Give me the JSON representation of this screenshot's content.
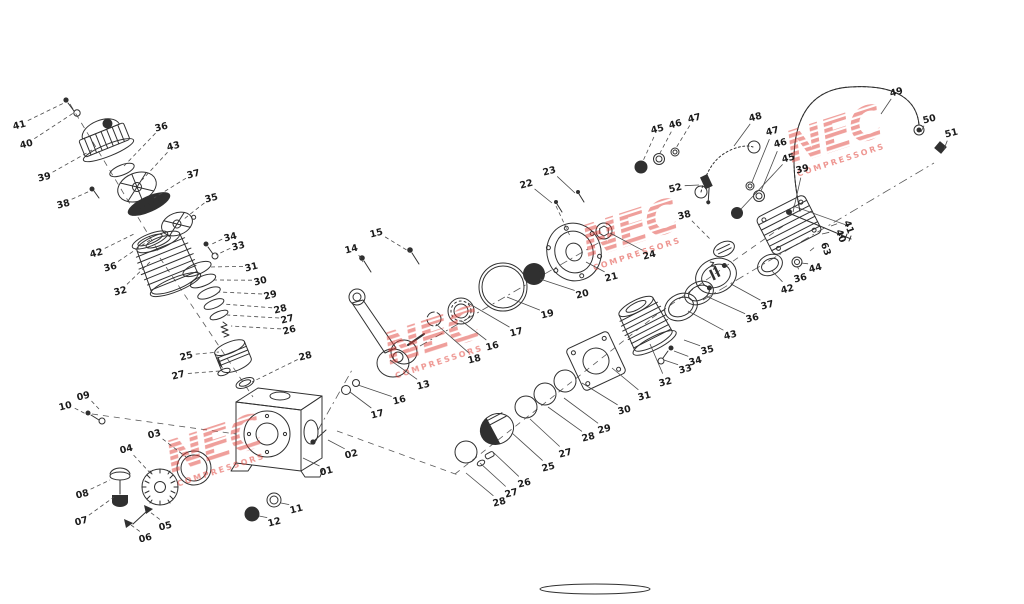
{
  "diagram": {
    "type": "exploded-parts-diagram",
    "subject": "air compressor pump exploded parts view",
    "background": "#ffffff",
    "line_color": "#303030",
    "watermark": {
      "primary": "NEC",
      "secondary": "COMPRESSORS",
      "color": "#e04038",
      "stamps": [
        {
          "x": 218,
          "y": 460,
          "r": -18
        },
        {
          "x": 436,
          "y": 352,
          "r": -18
        },
        {
          "x": 634,
          "y": 244,
          "r": -18
        },
        {
          "x": 838,
          "y": 150,
          "r": -18
        }
      ]
    },
    "labels": [
      {
        "n": "41",
        "x": 20,
        "y": 128,
        "tx": 64,
        "ty": 103,
        "ls": "d"
      },
      {
        "n": "40",
        "x": 27,
        "y": 147,
        "tx": 75,
        "ty": 112,
        "ls": "d"
      },
      {
        "n": "39",
        "x": 45,
        "y": 180,
        "tx": 92,
        "ty": 150,
        "ls": "d"
      },
      {
        "n": "36",
        "x": 162,
        "y": 130,
        "tx": 124,
        "ty": 166,
        "ls": "d"
      },
      {
        "n": "43",
        "x": 174,
        "y": 149,
        "tx": 142,
        "ty": 180,
        "ls": "d"
      },
      {
        "n": "37",
        "x": 194,
        "y": 177,
        "tx": 154,
        "ty": 198,
        "ls": "d"
      },
      {
        "n": "38",
        "x": 64,
        "y": 207,
        "tx": 90,
        "ty": 191,
        "ls": "d"
      },
      {
        "n": "35",
        "x": 212,
        "y": 201,
        "tx": 184,
        "ty": 219,
        "ls": "d"
      },
      {
        "n": "42",
        "x": 97,
        "y": 256,
        "tx": 136,
        "ty": 233,
        "ls": "d"
      },
      {
        "n": "36",
        "x": 111,
        "y": 270,
        "tx": 150,
        "ty": 240,
        "ls": "d"
      },
      {
        "n": "32",
        "x": 121,
        "y": 294,
        "tx": 150,
        "ty": 262,
        "ls": "d"
      },
      {
        "n": "34",
        "x": 231,
        "y": 240,
        "tx": 210,
        "ty": 245,
        "ls": "d"
      },
      {
        "n": "33",
        "x": 239,
        "y": 249,
        "tx": 216,
        "ty": 255,
        "ls": "d"
      },
      {
        "n": "31",
        "x": 252,
        "y": 270,
        "tx": 210,
        "ty": 267,
        "ls": "d"
      },
      {
        "n": "30",
        "x": 261,
        "y": 284,
        "tx": 214,
        "ty": 280,
        "ls": "d"
      },
      {
        "n": "29",
        "x": 271,
        "y": 298,
        "tx": 219,
        "ty": 292,
        "ls": "d"
      },
      {
        "n": "28",
        "x": 281,
        "y": 312,
        "tx": 223,
        "ty": 304,
        "ls": "d"
      },
      {
        "n": "27",
        "x": 288,
        "y": 322,
        "tx": 227,
        "ty": 315,
        "ls": "d"
      },
      {
        "n": "26",
        "x": 290,
        "y": 333,
        "tx": 231,
        "ty": 326,
        "ls": "d"
      },
      {
        "n": "25",
        "x": 187,
        "y": 359,
        "tx": 219,
        "ty": 352,
        "ls": "d"
      },
      {
        "n": "27",
        "x": 179,
        "y": 378,
        "tx": 220,
        "ty": 371,
        "ls": "d"
      },
      {
        "n": "28",
        "x": 306,
        "y": 359,
        "tx": 252,
        "ty": 382,
        "ls": "d"
      },
      {
        "n": "10",
        "x": 66,
        "y": 409,
        "tx": 86,
        "ty": 414,
        "ls": "d"
      },
      {
        "n": "09",
        "x": 84,
        "y": 399,
        "tx": 99,
        "ty": 409,
        "ls": "d"
      },
      {
        "n": "03",
        "x": 155,
        "y": 437,
        "tx": 186,
        "ty": 457,
        "ls": "d"
      },
      {
        "n": "04",
        "x": 127,
        "y": 452,
        "tx": 152,
        "ty": 475,
        "ls": "d"
      },
      {
        "n": "08",
        "x": 83,
        "y": 497,
        "tx": 110,
        "ty": 480,
        "ls": "d"
      },
      {
        "n": "07",
        "x": 82,
        "y": 524,
        "tx": 114,
        "ty": 497,
        "ls": "d"
      },
      {
        "n": "06",
        "x": 146,
        "y": 541,
        "tx": 131,
        "ty": 525,
        "ls": "d"
      },
      {
        "n": "05",
        "x": 166,
        "y": 529,
        "tx": 150,
        "ty": 512,
        "ls": "d"
      },
      {
        "n": "12",
        "x": 275,
        "y": 525,
        "tx": 259,
        "ty": 516,
        "ls": "s"
      },
      {
        "n": "11",
        "x": 297,
        "y": 512,
        "tx": 281,
        "ty": 503,
        "ls": "s"
      },
      {
        "n": "01",
        "x": 327,
        "y": 474,
        "tx": 303,
        "ty": 458,
        "ls": "s"
      },
      {
        "n": "02",
        "x": 352,
        "y": 457,
        "tx": 328,
        "ty": 440,
        "ls": "s"
      },
      {
        "n": "14",
        "x": 352,
        "y": 252,
        "tx": 363,
        "ty": 262,
        "ls": "d"
      },
      {
        "n": "15",
        "x": 377,
        "y": 236,
        "tx": 410,
        "ty": 252,
        "ls": "d"
      },
      {
        "n": "17",
        "x": 378,
        "y": 417,
        "tx": 350,
        "ty": 392,
        "ls": "s"
      },
      {
        "n": "16",
        "x": 400,
        "y": 403,
        "tx": 358,
        "ty": 385,
        "ls": "s"
      },
      {
        "n": "13",
        "x": 424,
        "y": 388,
        "tx": 390,
        "ty": 360,
        "ls": "s"
      },
      {
        "n": "18",
        "x": 475,
        "y": 362,
        "tx": 436,
        "ty": 324,
        "ls": "s"
      },
      {
        "n": "16",
        "x": 493,
        "y": 349,
        "tx": 463,
        "ty": 322,
        "ls": "s"
      },
      {
        "n": "17",
        "x": 517,
        "y": 335,
        "tx": 468,
        "ty": 303,
        "ls": "s"
      },
      {
        "n": "19",
        "x": 548,
        "y": 317,
        "tx": 507,
        "ty": 297,
        "ls": "s"
      },
      {
        "n": "20",
        "x": 583,
        "y": 297,
        "tx": 540,
        "ty": 279,
        "ls": "s"
      },
      {
        "n": "21",
        "x": 612,
        "y": 280,
        "tx": 586,
        "ty": 262,
        "ls": "s"
      },
      {
        "n": "22",
        "x": 527,
        "y": 187,
        "tx": 552,
        "ty": 203,
        "ls": "s"
      },
      {
        "n": "23",
        "x": 550,
        "y": 174,
        "tx": 575,
        "ty": 193,
        "ls": "s"
      },
      {
        "n": "24",
        "x": 650,
        "y": 258,
        "tx": 610,
        "ty": 233,
        "ls": "s"
      },
      {
        "n": "45",
        "x": 658,
        "y": 132,
        "tx": 643,
        "ty": 161,
        "ls": "d"
      },
      {
        "n": "46",
        "x": 676,
        "y": 127,
        "tx": 660,
        "ty": 153,
        "ls": "d"
      },
      {
        "n": "47",
        "x": 695,
        "y": 121,
        "tx": 676,
        "ty": 148,
        "ls": "d"
      },
      {
        "n": "48",
        "x": 756,
        "y": 120,
        "tx": 734,
        "ty": 146,
        "ls": "s"
      },
      {
        "n": "52",
        "x": 676,
        "y": 191,
        "tx": 699,
        "ty": 185,
        "ls": "s"
      },
      {
        "n": "47",
        "x": 773,
        "y": 134,
        "tx": 752,
        "ty": 182,
        "ls": "s"
      },
      {
        "n": "46",
        "x": 781,
        "y": 146,
        "tx": 761,
        "ty": 191,
        "ls": "s"
      },
      {
        "n": "45",
        "x": 789,
        "y": 161,
        "tx": 741,
        "ty": 209,
        "ls": "s"
      },
      {
        "n": "39",
        "x": 803,
        "y": 172,
        "tx": 793,
        "ty": 212,
        "ls": "s"
      },
      {
        "n": "38",
        "x": 685,
        "y": 218,
        "tx": 711,
        "ty": 240,
        "ls": "d"
      },
      {
        "n": "36",
        "x": 801,
        "y": 281,
        "tx": 797,
        "ty": 266,
        "ls": "s"
      },
      {
        "n": "42",
        "x": 788,
        "y": 292,
        "tx": 772,
        "ty": 271,
        "ls": "s"
      },
      {
        "n": "37",
        "x": 768,
        "y": 308,
        "tx": 731,
        "ty": 284,
        "ls": "s"
      },
      {
        "n": "36",
        "x": 753,
        "y": 321,
        "tx": 706,
        "ty": 296,
        "ls": "s"
      },
      {
        "n": "43",
        "x": 731,
        "y": 338,
        "tx": 688,
        "ty": 311,
        "ls": "s"
      },
      {
        "n": "35",
        "x": 708,
        "y": 353,
        "tx": 684,
        "ty": 340,
        "ls": "s"
      },
      {
        "n": "34",
        "x": 696,
        "y": 364,
        "tx": 674,
        "ty": 351,
        "ls": "s"
      },
      {
        "n": "33",
        "x": 686,
        "y": 372,
        "tx": 664,
        "ty": 360,
        "ls": "s"
      },
      {
        "n": "32",
        "x": 666,
        "y": 385,
        "tx": 650,
        "ty": 344,
        "ls": "s"
      },
      {
        "n": "31",
        "x": 645,
        "y": 399,
        "tx": 612,
        "ty": 368,
        "ls": "s"
      },
      {
        "n": "30",
        "x": 625,
        "y": 413,
        "tx": 582,
        "ty": 383,
        "ls": "s"
      },
      {
        "n": "29",
        "x": 605,
        "y": 432,
        "tx": 564,
        "ty": 398,
        "ls": "s"
      },
      {
        "n": "28",
        "x": 589,
        "y": 440,
        "tx": 548,
        "ty": 407,
        "ls": "s"
      },
      {
        "n": "27",
        "x": 566,
        "y": 456,
        "tx": 530,
        "ty": 419,
        "ls": "s"
      },
      {
        "n": "25",
        "x": 549,
        "y": 470,
        "tx": 512,
        "ty": 433,
        "ls": "s"
      },
      {
        "n": "26",
        "x": 525,
        "y": 486,
        "tx": 494,
        "ty": 453,
        "ls": "s"
      },
      {
        "n": "27",
        "x": 512,
        "y": 496,
        "tx": 480,
        "ty": 463,
        "ls": "s"
      },
      {
        "n": "28",
        "x": 500,
        "y": 505,
        "tx": 466,
        "ty": 473,
        "ls": "s"
      },
      {
        "n": "49",
        "x": 897,
        "y": 95,
        "tx": 881,
        "ty": 114,
        "ls": "s"
      },
      {
        "n": "50",
        "x": 930,
        "y": 122,
        "tx": 921,
        "ty": 132,
        "ls": "s"
      },
      {
        "n": "51",
        "x": 952,
        "y": 136,
        "tx": 944,
        "ty": 149,
        "ls": "s"
      },
      {
        "n": "41",
        "x": 846,
        "y": 228,
        "tx": 831,
        "ty": 226,
        "ls": "s",
        "r": 70
      },
      {
        "n": "40",
        "x": 838,
        "y": 237,
        "tx": 822,
        "ty": 234,
        "ls": "s",
        "r": 70
      },
      {
        "n": "63",
        "x": 823,
        "y": 250,
        "tx": 810,
        "ty": 251,
        "ls": "s",
        "r": 70
      },
      {
        "n": "44",
        "x": 816,
        "y": 271,
        "tx": 801,
        "ty": 263,
        "ls": "s"
      }
    ]
  }
}
